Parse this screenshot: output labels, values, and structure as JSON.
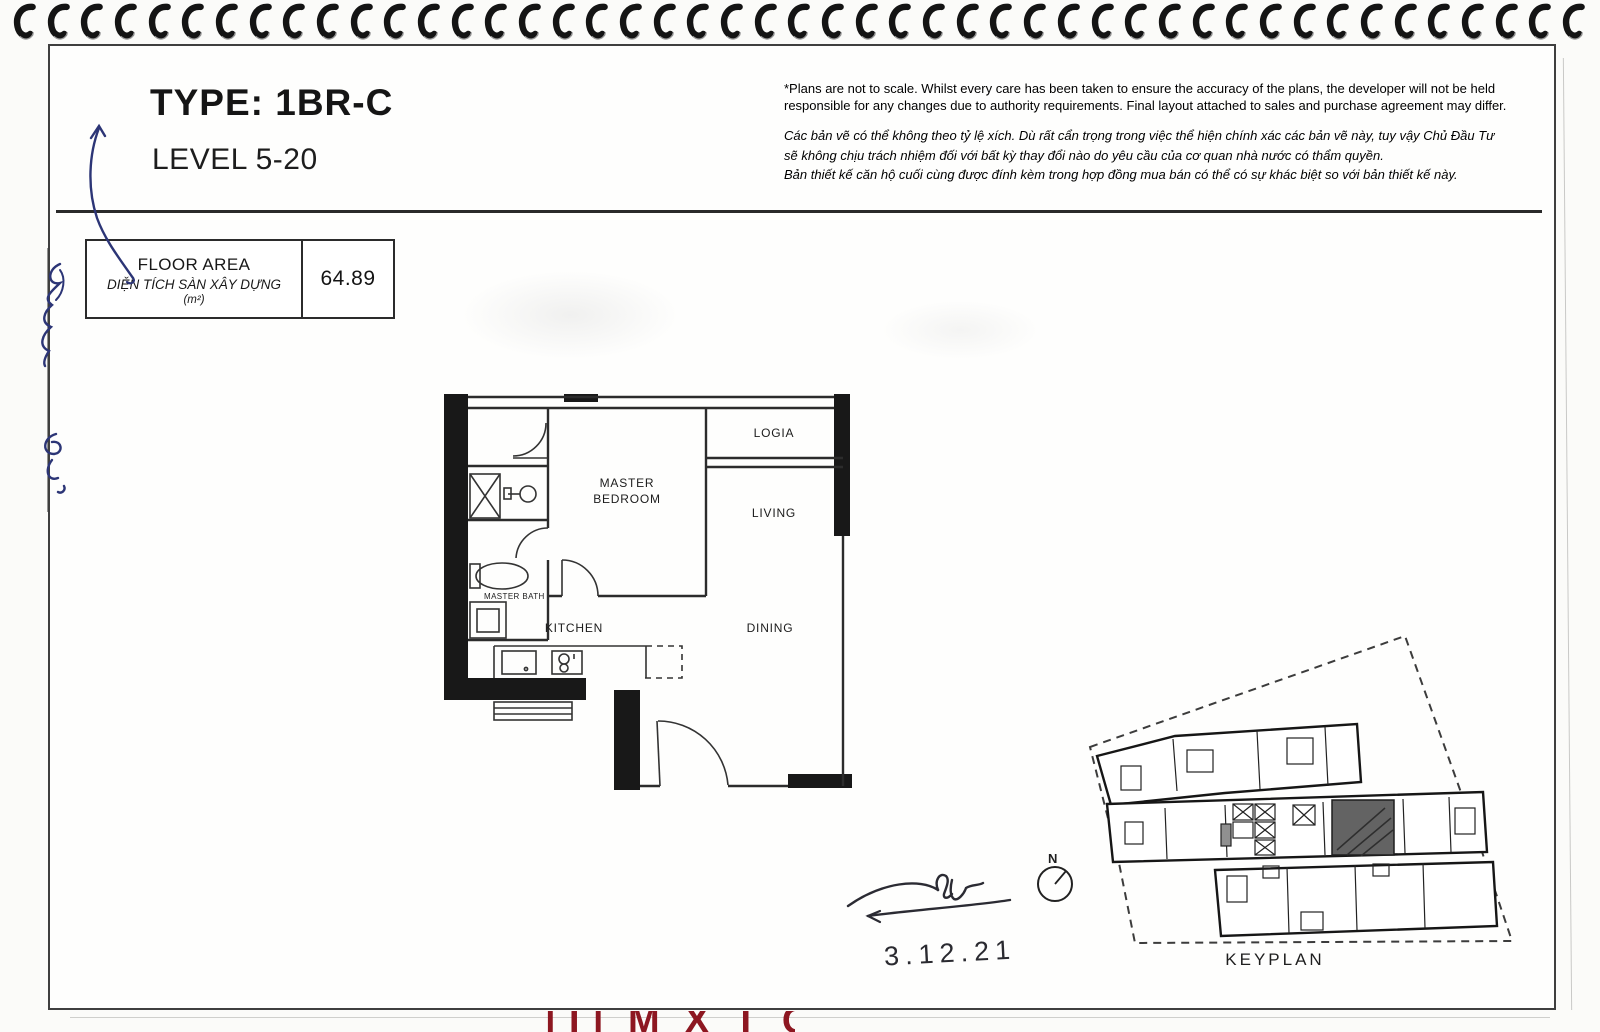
{
  "header": {
    "title": "TYPE: 1BR-C",
    "subtitle": "LEVEL 5-20"
  },
  "disclaimer": {
    "english": "*Plans are not to scale. Whilst every care has been taken to ensure the accuracy of the plans, the developer will not be held responsible for any changes due to authority requirements. Final layout attached to sales and purchase agreement may differ.",
    "vi_line1": "Các bản vẽ có thể không theo tỷ lệ xích. Dù rất cẩn trọng trong việc thể hiện chính xác các bản vẽ này, tuy vậy Chủ Đầu Tư",
    "vi_line2": "sẽ không chịu trách nhiệm đối với bất kỳ thay đổi nào do yêu cầu của cơ quan nhà nước có thẩm quyền.",
    "vi_line3": "Bản thiết kế căn hộ cuối cùng được đính kèm trong hợp đồng mua bán có thể có sự khác biệt so với bản thiết kế này."
  },
  "floor_area": {
    "label_en": "FLOOR AREA",
    "label_vi": "DIỆN TÍCH SÀN XÂY DỰNG",
    "unit": "(m²)",
    "value": "64.89"
  },
  "floor_plan": {
    "master_bedroom_line1": "MASTER",
    "master_bedroom_line2": "BEDROOM",
    "logia": "LOGIA",
    "living": "LIVING",
    "kitchen": "KITCHEN",
    "dining": "DINING",
    "master_bath": "MASTER BATH"
  },
  "keyplan": {
    "label": "KEYPLAN",
    "north_label": "N"
  },
  "annotations": {
    "date": "3.12.21"
  },
  "footer": {
    "logo_fragment": "|T|  M X T O  |T|"
  },
  "binding": {
    "coil_count": 47
  },
  "colors": {
    "ink": "#1c1c1c",
    "pen_blue": "#2c3576",
    "logo_red": "#8d1721"
  }
}
